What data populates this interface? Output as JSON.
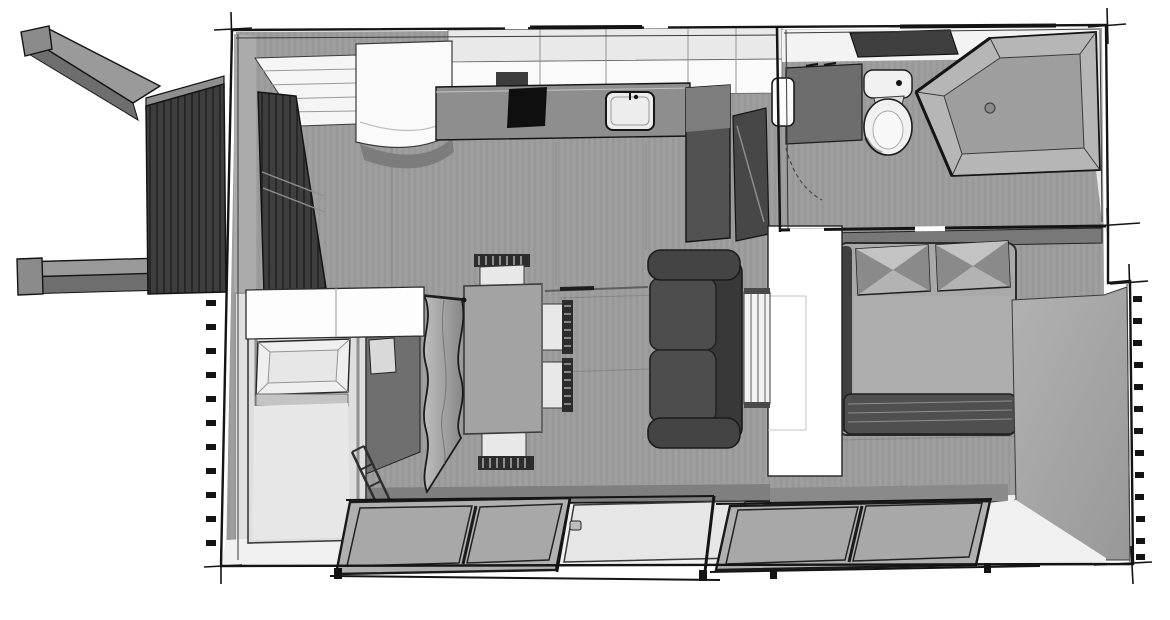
{
  "scene": {
    "description": "3D top-down floor plan of a tiny house / mobile home, grayscale sketch render",
    "rooms": [
      "kitchen",
      "bathroom",
      "bedroom",
      "living-dining",
      "kids-nook",
      "entry-deck"
    ]
  },
  "labels": {
    "scene": "3D floor plan, top-down axonometric grayscale render",
    "hitch": "Towing hitch beams",
    "deck": "Slatted entry deck",
    "entry_door": "Open slatted entry door",
    "steps": "Entry steps and shelving",
    "fridge": "Refrigerator cabinet with curved front",
    "upper_cabinets": "Kitchen upper cabinets",
    "counter": "Kitchen counter",
    "cooktop": "Cooktop",
    "sink": "Kitchen sink with faucet",
    "tall_cabinet": "Tall kitchen cabinet",
    "bath_door": "Open bathroom door",
    "bathroom": "Bathroom",
    "skylight": "Skylight",
    "vanity": "Bathroom vanity",
    "mirror": "Mirror",
    "toilet": "Toilet",
    "shower": "Walk-in shower with drain",
    "bedroom": "Bedroom",
    "bed": "Double bed with two pillows and blanket",
    "wardrobe": "Wardrobe partition",
    "shelf_slats": "Slatted shelf unit",
    "sofa": "Two-seat sofa",
    "table": "Dining table",
    "chairs": "Dining chairs with slatted backs",
    "curtain": "Privacy curtain",
    "kids_nook": "Second bed nook",
    "kids_cabinet": "Overhead cabinet",
    "kids_bed": "Single bed with pillow",
    "bed_rail": "Bed foot rail",
    "doors_left": "Sliding glass doors (living room)",
    "door_center": "Sliding glass panel (open)",
    "doors_right": "Sliding glass doors (bedroom)",
    "shell": "Exterior walls"
  },
  "palette": {
    "paper": "#ffffff",
    "ink": "#141414",
    "line": "#3a3a3a",
    "floor": "#9c9c9c",
    "floorLight": "#e0e0e0",
    "sill": "#f0f0f0",
    "wallFaceA": "#b2b2b2",
    "wallFaceB": "#989898",
    "wallBand": "#7f7f7f",
    "deck": "#3e3e3e",
    "deckSlat": "#282828",
    "beamTop": "#9a9a9a",
    "beamSide": "#6e6e6e",
    "beamCap": "#8b8b8b",
    "cabWhite": "#fafafa",
    "cabTop": "#e9e9e9",
    "counter": "#8e8e8e",
    "cooktop": "#0f0f0f",
    "sinkFill": "#ededed",
    "tallCab": "#525252",
    "tallCabTop": "#7d7d7d",
    "niche": "#3c3c3c",
    "ceiling": "#f3f3f3",
    "skylight": "#3f3f3f",
    "vanity": "#6d6d6d",
    "porcelain": "#f1f1f1",
    "showerWall": "#b6b6b6",
    "showerFloor": "#9e9e9e",
    "shelf": "#787878",
    "bedBase": "#a9a9a9",
    "bedRail": "#3f3f3f",
    "pillow": "#b3b3b3",
    "pillowDark": "#8a8a8a",
    "mattress": "#aeaeae",
    "blanket": "#4f4f4f",
    "wardrobe": "#ffffff",
    "sofaSeat": "#4d4d4d",
    "sofaBack": "#383838",
    "sofaArm": "#444444",
    "tableTop": "#a3a3a3",
    "chairSeat": "#e8e8e8",
    "chairBack": "#2c2c2c",
    "curtainA": "#bdbdbd",
    "curtainB": "#878787",
    "kidBed": "#dedede",
    "kidPillow": "#efefef",
    "kidBlanket": "#e7e7e7",
    "sidePanel": "#6f6f6f",
    "glass": "#a8a8a8",
    "glassLight": "#e6e6e6",
    "frame": "#1a1a1a"
  }
}
